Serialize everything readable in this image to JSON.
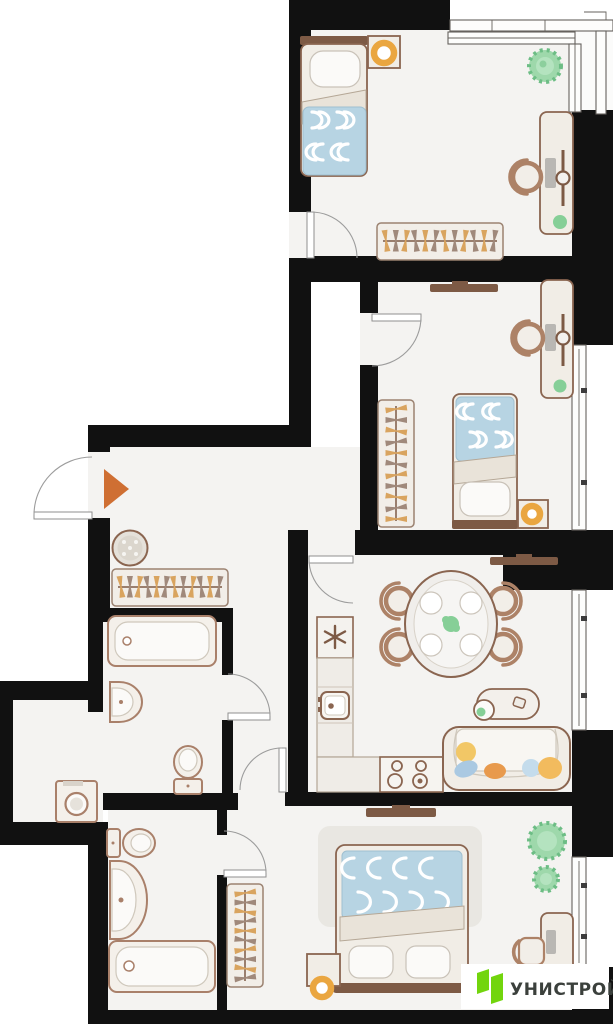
{
  "logo": {
    "text": "УНИСТРОЙ"
  },
  "colors": {
    "wall": "#111111",
    "floor": "#f4f3f1",
    "outline": "#8a6550",
    "wood": "#7d5a45",
    "furn": "#f1ede6",
    "blanket": "#b7d4e3",
    "accent_orange": "#cf6f33",
    "lamp": "#eaa640",
    "plant": "#9ed8ab",
    "plant_dark": "#6dbd85",
    "hanger_tan": "#d9a45f",
    "hanger_brown": "#a0897b",
    "green": "#86cf97",
    "pillow_yellow": "#f2c766",
    "pillow_blue": "#aac9e2",
    "pillow_orange": "#e89a4d",
    "logo_green": "#72d50d",
    "logo_text": "#3b403c"
  },
  "plan": {
    "type": "apartment-floor-plan",
    "rooms": [
      {
        "name": "bedroom-1",
        "furniture": [
          "single-bed",
          "nightstand-with-lamp",
          "plant",
          "desk",
          "chair",
          "wardrobe"
        ]
      },
      {
        "name": "bedroom-2",
        "furniture": [
          "tv",
          "desk",
          "chair",
          "wardrobe",
          "single-bed",
          "nightstand-with-lamp"
        ]
      },
      {
        "name": "hallway",
        "furniture": [
          "entrance-arrow",
          "pouf",
          "wardrobe"
        ]
      },
      {
        "name": "bathroom-1",
        "furniture": [
          "bathtub",
          "wall-sink",
          "toilet"
        ]
      },
      {
        "name": "storage-niche",
        "furniture": [
          "washing-machine"
        ]
      },
      {
        "name": "bathroom-2",
        "furniture": [
          "toilet",
          "vanity-sink",
          "bathtub"
        ]
      },
      {
        "name": "kitchen-living-room",
        "furniture": [
          "fridge",
          "counter-with-sink",
          "stove",
          "dining-table-with-4-chairs",
          "tv",
          "coffee-table",
          "sofa-with-pillows"
        ]
      },
      {
        "name": "master-bedroom",
        "furniture": [
          "tv",
          "rug",
          "double-bed",
          "nightstand-with-lamp",
          "wardrobe",
          "plants",
          "desk",
          "chair"
        ]
      },
      {
        "name": "glazed-balcony",
        "furniture": []
      }
    ]
  }
}
